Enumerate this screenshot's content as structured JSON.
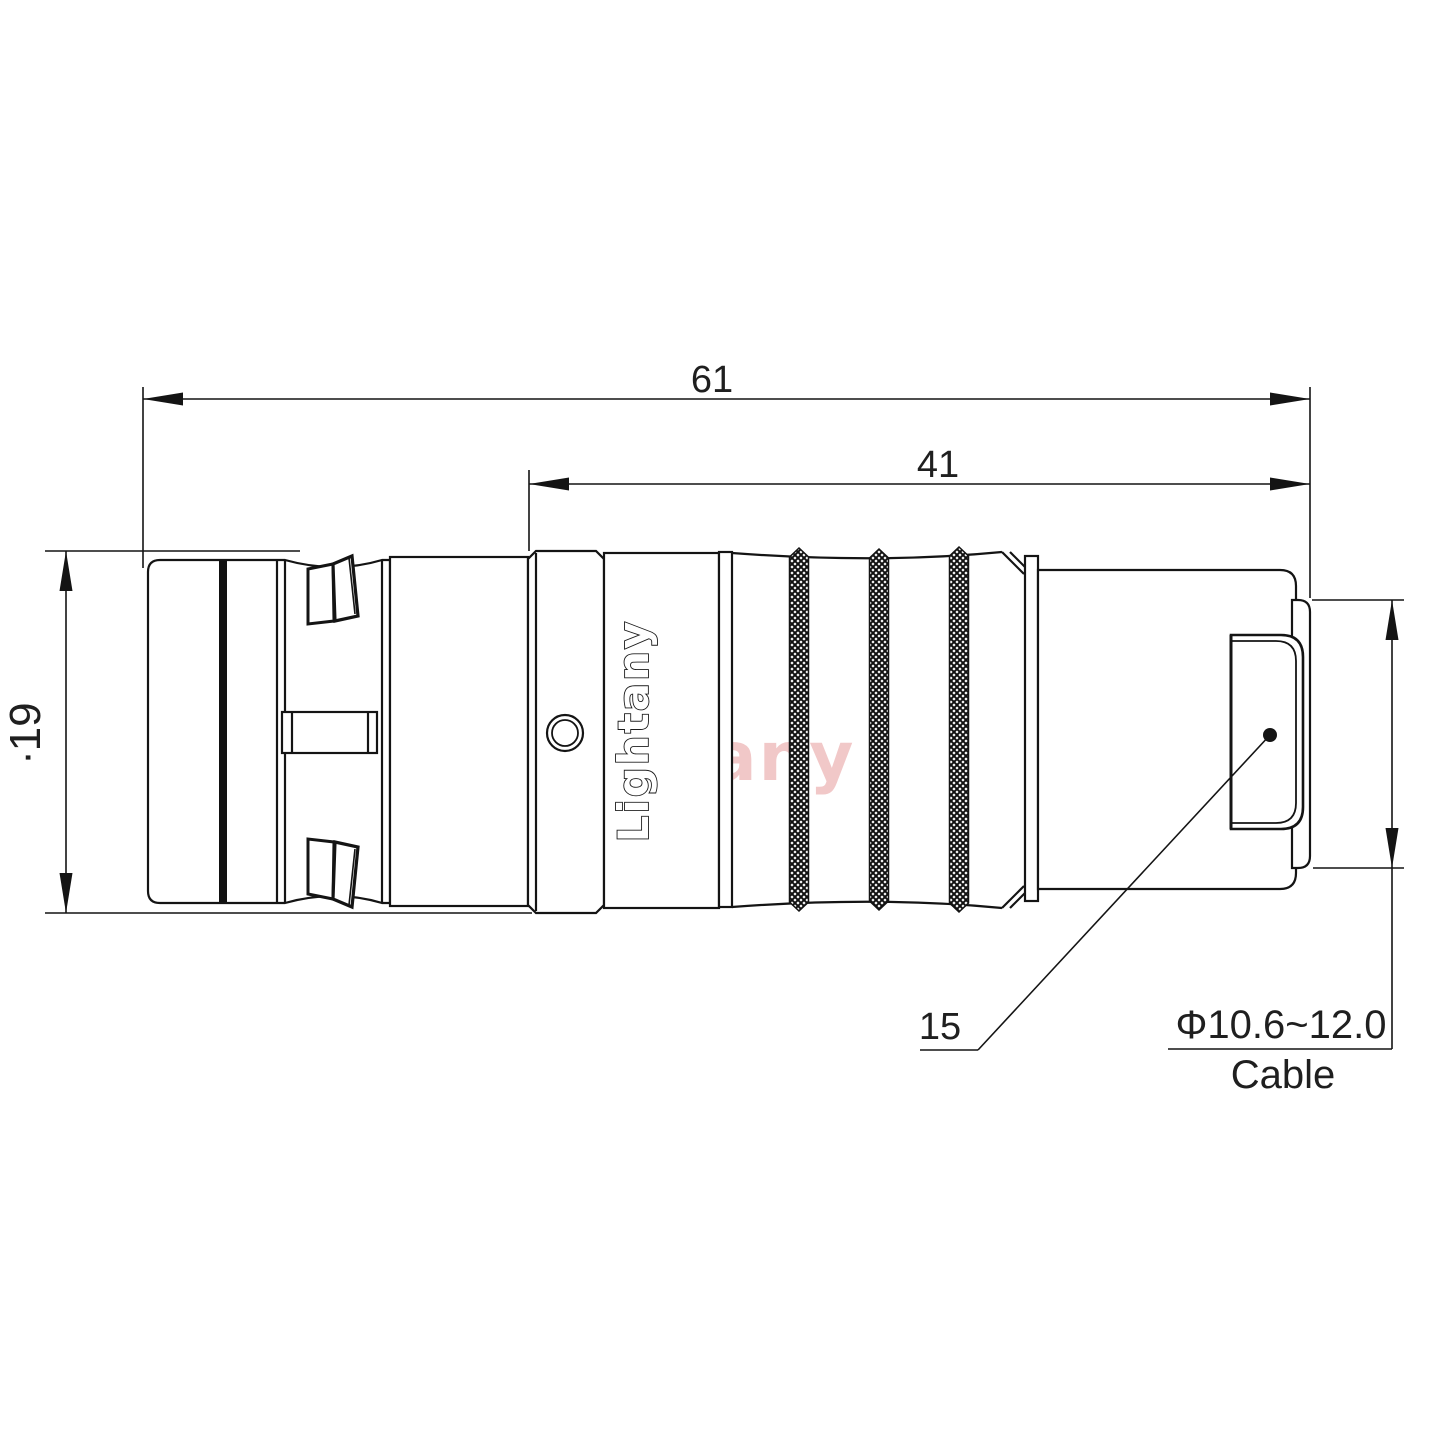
{
  "drawing": {
    "background": "#ffffff",
    "line_color": "#141414",
    "watermark_color": "#d86060",
    "watermark_opacity": "0.34",
    "dimensions": {
      "overall_length": "61",
      "rear_length": "41",
      "body_diameter": "∙19",
      "item_ref": "15",
      "cable_diameter": "Φ10.6~12.0",
      "cable_label": "Cable"
    },
    "brand": {
      "engraving": "Lightany",
      "watermark": "Lightany"
    }
  }
}
